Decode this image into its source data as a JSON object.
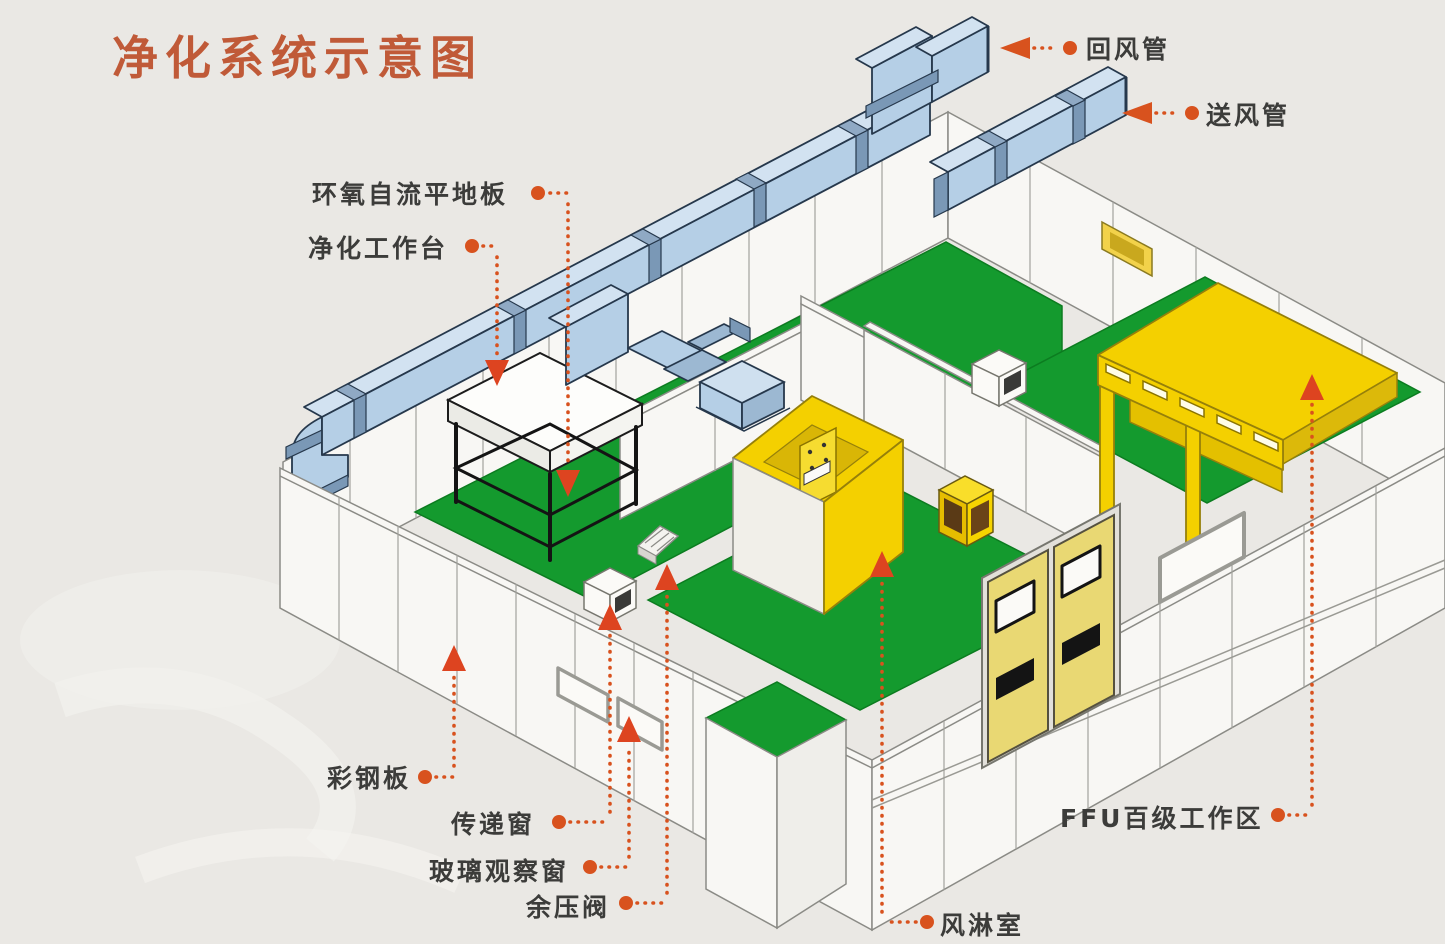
{
  "title": {
    "text": "净化系统示意图"
  },
  "diagram": {
    "type": "isometric-cutaway",
    "subject": "cleanroom air purification system schematic",
    "labels": {
      "return_duct": "回风管",
      "supply_duct": "送风管",
      "epoxy_self_leveling_floor": "环氧自流平地板",
      "clean_workbench": "净化工作台",
      "color_steel_panel": "彩钢板",
      "transfer_window": "传递窗",
      "glass_observation_window": "玻璃观察窗",
      "residual_pressure_valve": "余压阀",
      "air_shower": "风淋室",
      "ffu_class100_work_area": "FFU百级工作区"
    },
    "colors": {
      "title_text": "#c05a38",
      "label_text": "#3c3c3a",
      "leader_accent": "#d8521e",
      "pointer_arrow": "#dd4420",
      "duct_blue": "#b5cfe6",
      "duct_blue_top": "#d2e2f1",
      "duct_flange": "#7a98b6",
      "floor_green": "#149a2e",
      "cleanroom_yellow": "#f4d000",
      "door_yellow": "#e9d873",
      "wall_white": "#f8f7f4",
      "background": "#eae8e4"
    }
  }
}
